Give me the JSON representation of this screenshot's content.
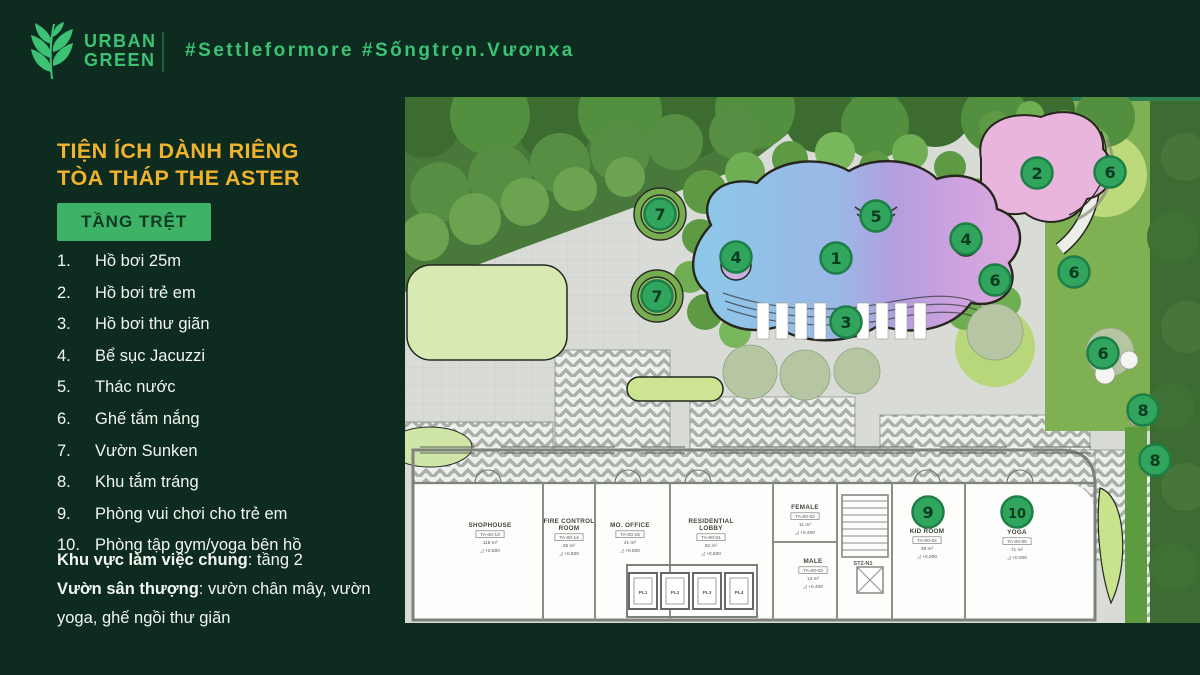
{
  "header": {
    "logo_line1": "URBAN",
    "logo_line2": "GREEN",
    "hashtag": "#Settleformore #Sốngtrọn.Vươnxa"
  },
  "panel": {
    "title_line1": "TIỆN ÍCH DÀNH RIÊNG",
    "title_line2": "TÒA THÁP THE ASTER",
    "floor_button": "TẦNG TRỆT",
    "amenities": [
      {
        "num": "1.",
        "label": "Hồ bơi 25m"
      },
      {
        "num": "2.",
        "label": "Hồ bơi trẻ em"
      },
      {
        "num": "3.",
        "label": "Hồ bơi thư giãn"
      },
      {
        "num": "4.",
        "label": "Bể sục Jacuzzi"
      },
      {
        "num": "5.",
        "label": "Thác nước"
      },
      {
        "num": "6.",
        "label": "Ghế tắm nắng"
      },
      {
        "num": "7.",
        "label": "Vườn Sunken"
      },
      {
        "num": "8.",
        "label": "Khu tắm tráng"
      },
      {
        "num": "9.",
        "label": "Phòng vui chơi cho trẻ em"
      },
      {
        "num": "10.",
        "label": "Phòng tập gym/yoga bên hồ"
      }
    ],
    "notes": [
      {
        "lead": "Khu vực làm việc chung",
        "rest": ": tầng 2"
      },
      {
        "lead": "Vườn sân thượng",
        "rest": ": vườn chân mây, vườn yoga, ghế ngồi thư giãn"
      }
    ]
  },
  "plan": {
    "markers": [
      {
        "n": "7",
        "x": 255,
        "y": 117
      },
      {
        "n": "7",
        "x": 252,
        "y": 199
      },
      {
        "n": "4",
        "x": 331,
        "y": 160
      },
      {
        "n": "1",
        "x": 431,
        "y": 161
      },
      {
        "n": "5",
        "x": 471,
        "y": 119
      },
      {
        "n": "3",
        "x": 441,
        "y": 225
      },
      {
        "n": "4",
        "x": 561,
        "y": 142
      },
      {
        "n": "2",
        "x": 632,
        "y": 76
      },
      {
        "n": "6",
        "x": 705,
        "y": 75
      },
      {
        "n": "6",
        "x": 590,
        "y": 183
      },
      {
        "n": "6",
        "x": 669,
        "y": 175
      },
      {
        "n": "6",
        "x": 698,
        "y": 256
      },
      {
        "n": "8",
        "x": 738,
        "y": 313
      },
      {
        "n": "8",
        "x": 750,
        "y": 363
      },
      {
        "n": "9",
        "x": 523,
        "y": 415
      },
      {
        "n": "10",
        "x": 612,
        "y": 415
      }
    ],
    "rooms": [
      {
        "name1": "SHOPHOUSE",
        "code": "TA-00-13",
        "area": "118 m²",
        "level": "+0.500",
        "x": 85,
        "y": 430
      },
      {
        "name1": "FIRE CONTROL",
        "name2": "ROOM",
        "code": "TA-00-14",
        "area": "25 m²",
        "level": "+0.500",
        "x": 164,
        "y": 426
      },
      {
        "name1": "MO. OFFICE",
        "code": "TA-00-15",
        "area": "41 m²",
        "level": "+0.500",
        "x": 225,
        "y": 430
      },
      {
        "name1": "RESIDENTIAL",
        "name2": "LOBBY",
        "code": "TA-00-01",
        "area": "62 m²",
        "level": "+0.500",
        "x": 306,
        "y": 426
      },
      {
        "name1": "FEMALE",
        "code": "TA-00-02",
        "area": "11 m²",
        "level": "+0.400",
        "x": 400,
        "y": 412
      },
      {
        "name1": "MALE",
        "code": "TA-00-03",
        "area": "13 m²",
        "level": "+0.400",
        "x": 408,
        "y": 466
      },
      {
        "name1": "KID ROOM",
        "code": "TA-00-04",
        "area": "38 m²",
        "level": "+0.000",
        "x": 522,
        "y": 436
      },
      {
        "name1": "YOGA",
        "code": "TA-00-05",
        "area": "71 m²",
        "level": "+0.000",
        "x": 612,
        "y": 437
      }
    ],
    "elevators": [
      {
        "label": "PL1",
        "x": 238
      },
      {
        "label": "PL2",
        "x": 270
      },
      {
        "label": "PL3",
        "x": 302
      },
      {
        "label": "PL4",
        "x": 334
      }
    ],
    "stair_label": "ST2-N1"
  },
  "colors": {
    "bg": "#0d2b1e",
    "green": "#3cc175",
    "yellow": "#f0b32b",
    "btn": "#3eb368",
    "btn-text": "#0d3a23",
    "marker": "#31a55e",
    "pool-blue": "#8cc8e9",
    "pool-purple": "#b39ede",
    "pool-pink": "#e3aede"
  }
}
